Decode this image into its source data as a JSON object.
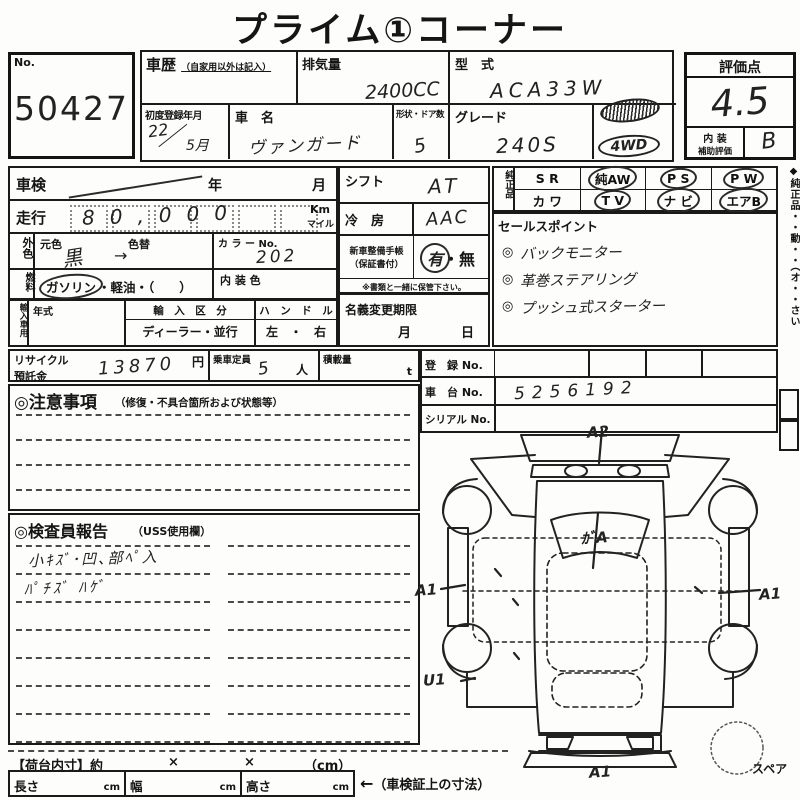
{
  "title": "プライム①コーナー",
  "lot": {
    "label": "No.",
    "number": "50427"
  },
  "header": {
    "history_label": "車歴",
    "history_note": "（自家用以外は記入）",
    "displacement_label": "排気量",
    "displacement_value": "2400CC",
    "model_label": "型　式",
    "model_value": "ACA33W",
    "first_reg_label": "初度登録年月",
    "first_reg_year": "22",
    "first_reg_slash": "／",
    "first_reg_month": "5月",
    "name_label": "車　名",
    "name_value": "ヴァンガード",
    "doors_label": "形状・ドア数",
    "doors_value": "5",
    "grade_label": "グレード",
    "grade_value": "240S",
    "stamp_4wd": "4WD"
  },
  "rating": {
    "label": "評価点",
    "score": "4.5",
    "interior_line1": "内 装",
    "interior_line2": "補助評価",
    "interior_grade": "B"
  },
  "vehicle": {
    "shaken_label": "車検",
    "shaken_year": "年",
    "shaken_month": "月",
    "mileage_label": "走行",
    "mileage_value": "80,000",
    "unit_km": "Km",
    "unit_mile": "マイル",
    "color_side": "外色",
    "color_orig_label": "元色",
    "color_change_label": "色替",
    "color_value": "黒",
    "color_arrow": "→",
    "color_no_label": "カ ラ ー No.",
    "color_no_value": "202",
    "fuel_side": "燃料",
    "fuel_gasoline": "ガソリン",
    "fuel_options": "・軽油・（　　）",
    "interior_color_label": "内 装 色",
    "import_side": "輸入車用",
    "import_year_label": "年式",
    "import_class_label": "輸　入　区　分",
    "import_class_value": "ディーラー・並行",
    "handle_label": "ハ　ン　ド　ル",
    "handle_value": "左　・　右"
  },
  "middle": {
    "shift_label": "シフト",
    "shift_value": "AT",
    "ac_label": "冷　房",
    "ac_value": "AAC",
    "booklet_label1": "新車整備手帳",
    "booklet_label2": "（保証書付）",
    "booklet_yes": "有",
    "booklet_sep": "・",
    "booklet_no": "無",
    "booklet_note": "※書類と一緒に保管下さい。",
    "transfer_label": "名義変更期限",
    "transfer_month": "月",
    "transfer_day": "日"
  },
  "genuine": {
    "side_label": "純正品",
    "rows": [
      [
        {
          "text": "S R",
          "circled": false
        },
        {
          "text": "純AW",
          "circled": true
        },
        {
          "text": "P S",
          "circled": true
        },
        {
          "text": "P W",
          "circled": true
        }
      ],
      [
        {
          "text": "カ ワ",
          "circled": false
        },
        {
          "text": "T V",
          "circled": true
        },
        {
          "text": "ナ ビ",
          "circled": true
        },
        {
          "text": "エアB",
          "circled": true
        }
      ]
    ]
  },
  "sales": {
    "label": "セールスポイント",
    "bullet": "◎",
    "items": [
      "バックモニター",
      "革巻ステアリング",
      "プッシュ式スターター"
    ]
  },
  "edge_note": "◆純正品・・動・・（オ・・さい",
  "recycle": {
    "label1": "リサイクル",
    "label2": "預託金",
    "value": "13870",
    "unit": "円",
    "capacity_label": "乗車定員",
    "capacity_value": "5",
    "capacity_unit": "人",
    "load_label": "積載量",
    "load_unit": "t"
  },
  "registration": {
    "reg_label": "登　録 No.",
    "chassis_label": "車　台 No.",
    "chassis_value": "5256192",
    "serial_label": "シリアル No."
  },
  "cautions": {
    "title": "◎注意事項",
    "note": "（修復・不具合箇所および状態等）"
  },
  "inspector": {
    "title": "◎検査員報告",
    "note": "（USS使用欄）",
    "lines": [
      "小ｷｽﾞ･凹､部ﾍﾟ入",
      "ﾊﾟﾁｽﾞ ﾊｹﾞ"
    ]
  },
  "diagram": {
    "spare_label": "スペア",
    "codes": [
      {
        "text": "A2",
        "x": 172,
        "y": 0
      },
      {
        "text": "ｶﾞA",
        "x": 166,
        "y": 104
      },
      {
        "text": "A1",
        "x": 0,
        "y": 158
      },
      {
        "text": "A1",
        "x": 344,
        "y": 162
      },
      {
        "text": "U1",
        "x": 8,
        "y": 248
      },
      {
        "text": "A1",
        "x": 174,
        "y": 340
      }
    ]
  },
  "dims": {
    "bed_label": "【荷台内寸】約",
    "x1": "×",
    "x2": "×",
    "unit": "（cm）",
    "length_label": "長さ",
    "width_label": "幅",
    "height_label": "高さ",
    "cm": "cm",
    "note_arrow": "←",
    "note": "（車検証上の寸法）"
  }
}
